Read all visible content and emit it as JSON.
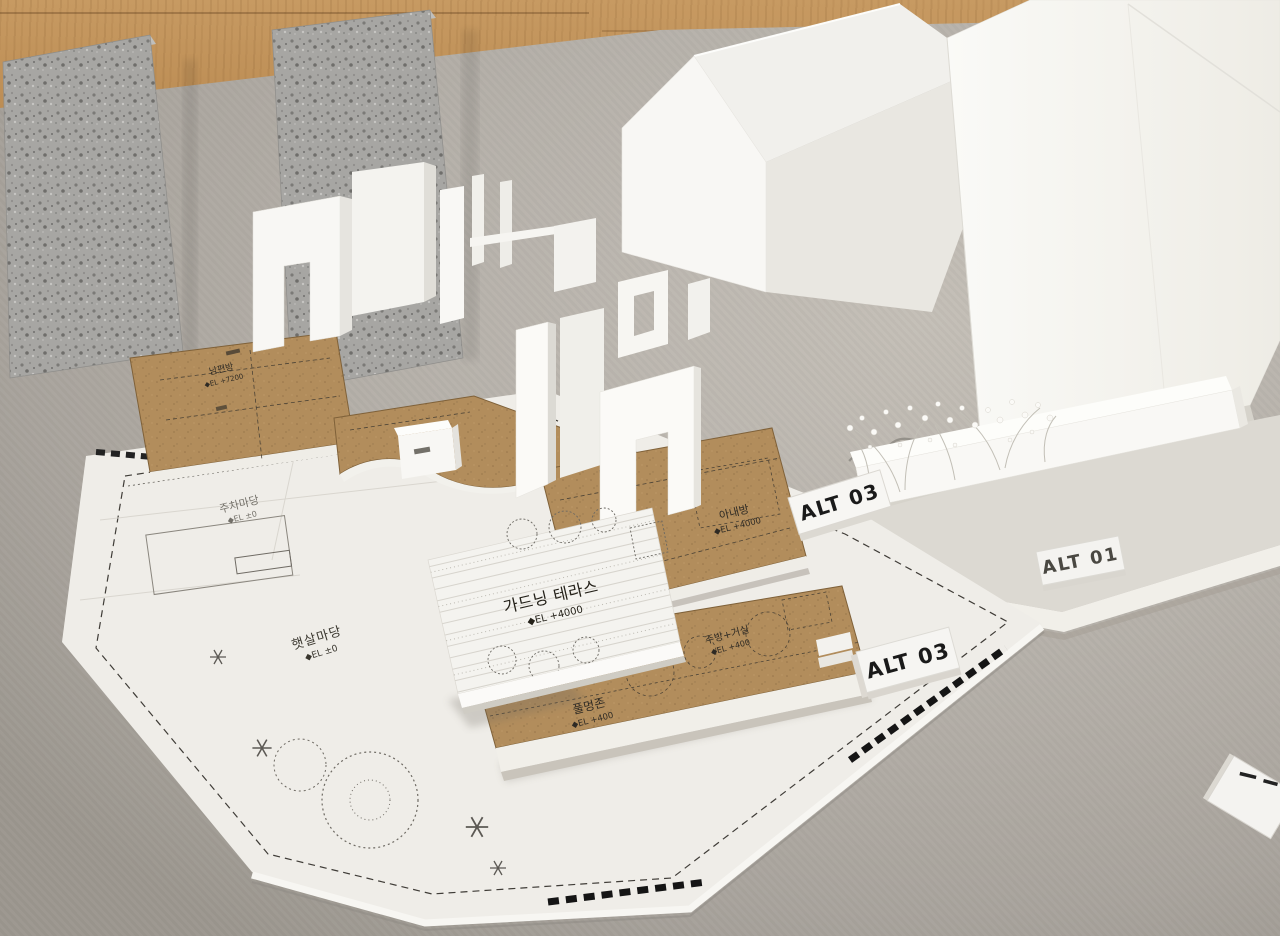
{
  "tags": {
    "front_right": "ALT 03",
    "base_right": "ALT 01",
    "lower": "ALT 03"
  },
  "plates": {
    "terrace": {
      "name": "가드닝 테라스",
      "el": "◆EL +4000"
    },
    "wife_room": {
      "name": "아내방",
      "el": "◆EL +4000"
    },
    "husband_room": {
      "name": "남편방",
      "el": "◆EL +7200"
    },
    "kitchen_living": {
      "name": "주방+거실",
      "el": "◆EL +400"
    },
    "grass_zone": {
      "name": "풀멍존",
      "el": "◆EL +400"
    },
    "cat_wheel": {
      "name": "캣휠"
    }
  },
  "site": {
    "sun_yard": {
      "name": "햇살마당",
      "el": "◆EL ±0"
    },
    "parking_yard": {
      "name": "주차마당",
      "el": "◆EL ±0"
    }
  },
  "colors": {
    "wood": "#b8884f",
    "mat": "#b4afa8",
    "site_paper": "#efede8",
    "chipboard": "#b28d5c",
    "foam_white": "#f7f6f3",
    "speckled_foam": "#a7a6a3",
    "ink": "#2e2a24"
  }
}
